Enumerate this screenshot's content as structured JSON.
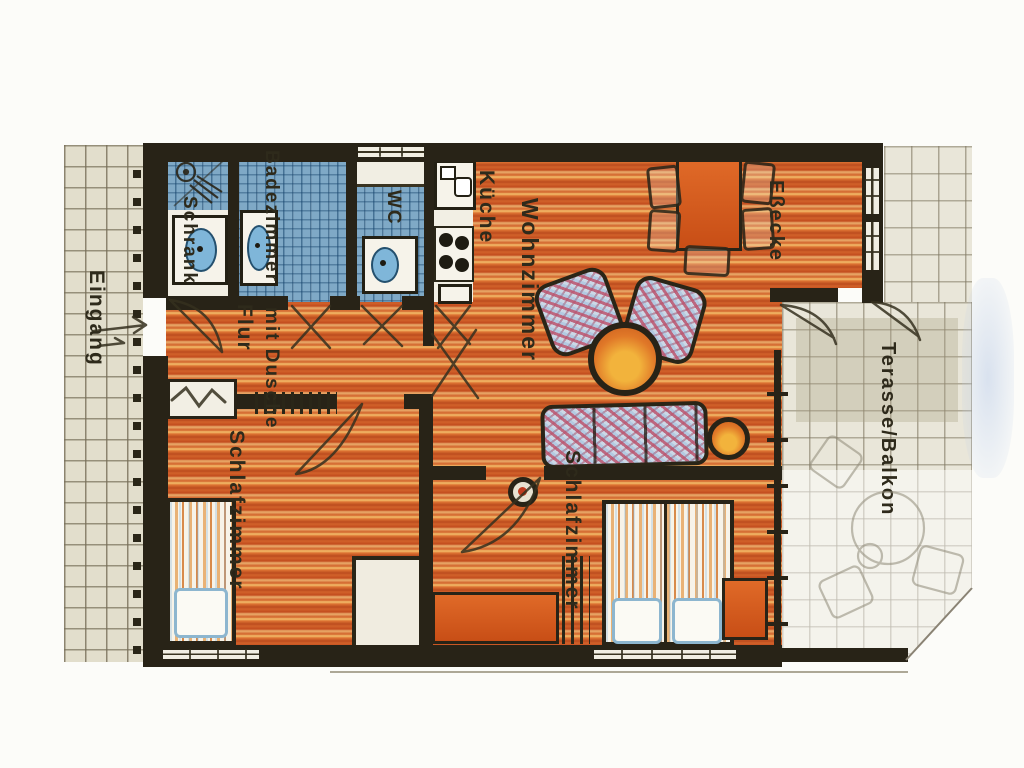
{
  "plan": {
    "type": "apartment-floor-plan",
    "language": "de"
  },
  "rooms": [
    {
      "id": "eingang",
      "label": "Eingang"
    },
    {
      "id": "schrank",
      "label": "Schrank"
    },
    {
      "id": "badezimmer",
      "label": "Badezimmer",
      "label2": "mit Dusche"
    },
    {
      "id": "wc",
      "label": "WC"
    },
    {
      "id": "kueche",
      "label": "Küche"
    },
    {
      "id": "wohnzimmer",
      "label": "Wohnzimmer"
    },
    {
      "id": "essecke",
      "label": "Eßecke"
    },
    {
      "id": "terrasse-balkon",
      "label": "Terasse/Balkon"
    },
    {
      "id": "flur",
      "label": "Flur"
    },
    {
      "id": "schlafzimmer-links",
      "label": "Schlafzimmer"
    },
    {
      "id": "schlafzimmer-rechts",
      "label": "Schlafzimmer"
    }
  ],
  "colors": {
    "wood_floor": "#d2622a",
    "wall": "#282317",
    "bath_tile": "#7fa9c6",
    "exterior_tile": "#e2decc",
    "terrace_tile": "#e9e6d9",
    "furniture_orange": "#d4591e",
    "upholstery_pink": "#c05a78",
    "upholstery_blue": "#9fc3dd",
    "label_text": "#2e2a1b"
  }
}
